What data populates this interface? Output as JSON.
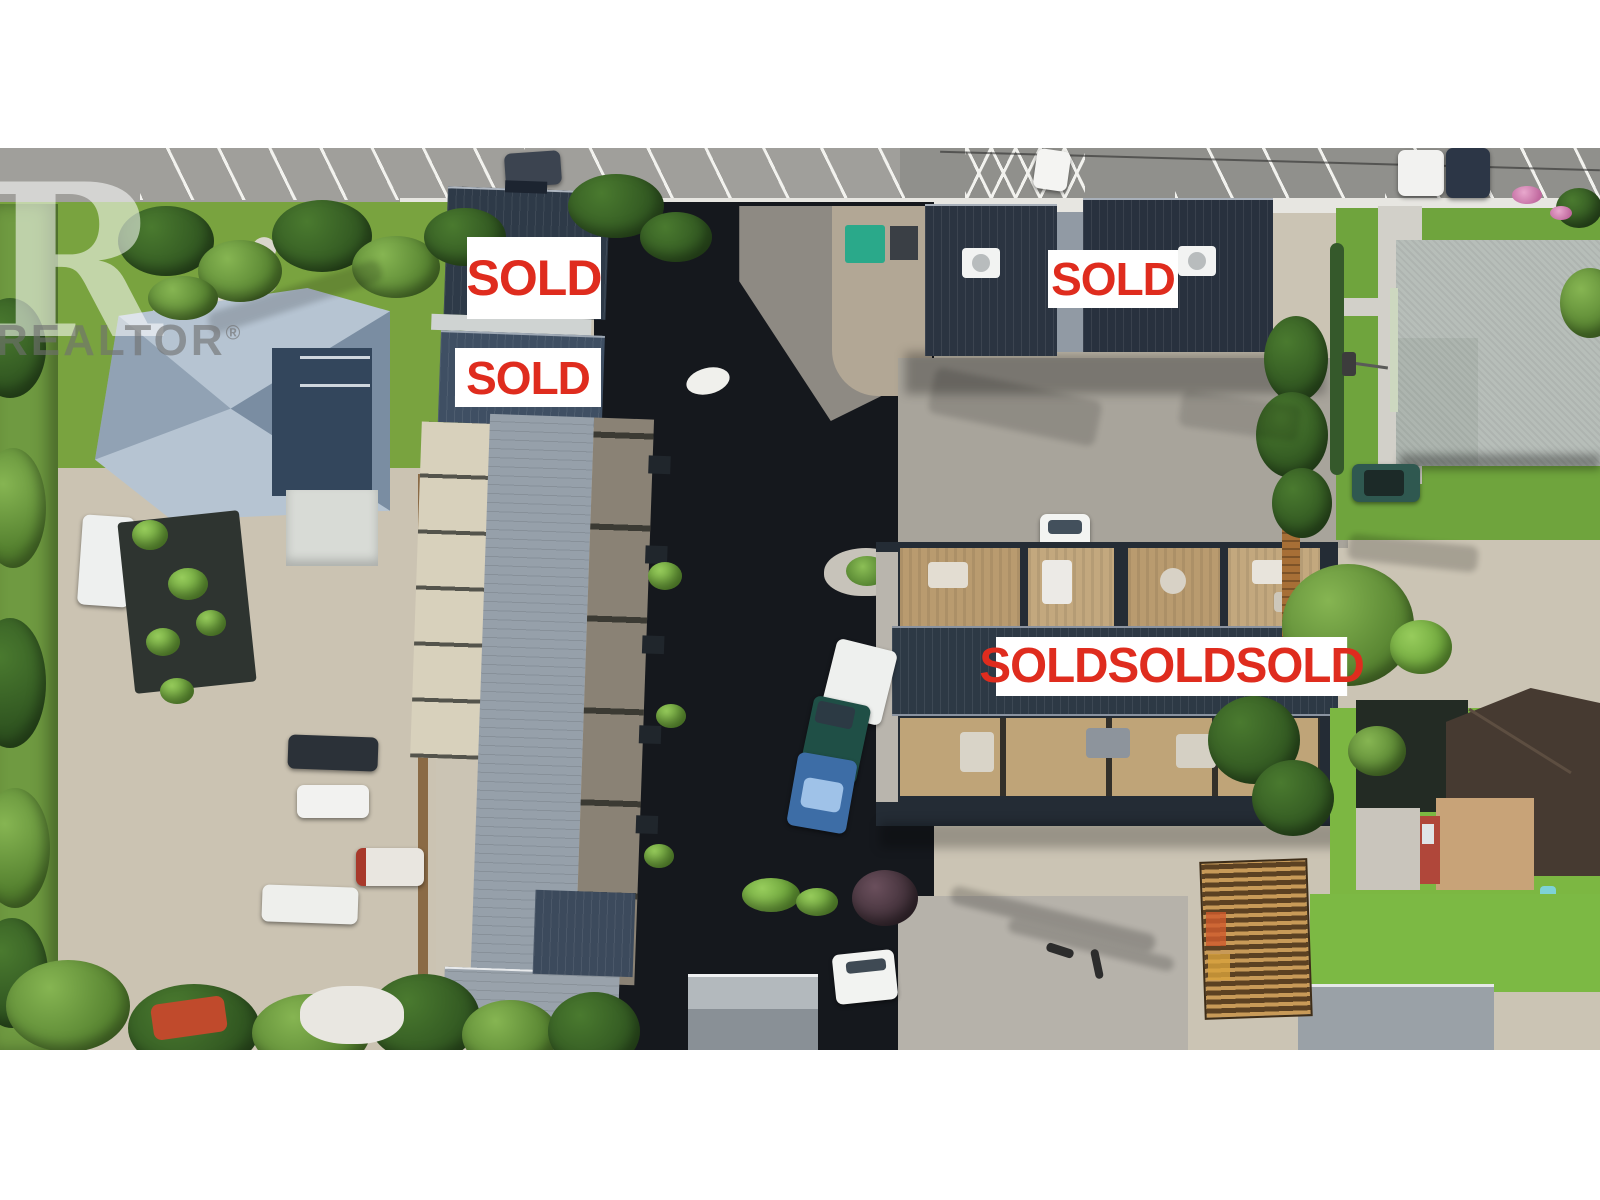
{
  "watermark": {
    "logo_letter": "R",
    "text": "REALTOR",
    "registered_mark": "®"
  },
  "sold_labels": {
    "townhouse_upper": "SOLD",
    "townhouse_lower": "SOLD",
    "north_building": "SOLD",
    "south_building_banner": "SOLDSOLDSOLD"
  },
  "colors": {
    "sold_text_red": "#df2c1e",
    "sign_background": "#ffffff",
    "watermark_gray": "#707070",
    "watermark_white": "#ffffff",
    "dark_roof": "#2b3441",
    "asphalt_dark": "#15181d",
    "lawn_green": "#79a33f",
    "gravel": "#cbc3b2"
  }
}
